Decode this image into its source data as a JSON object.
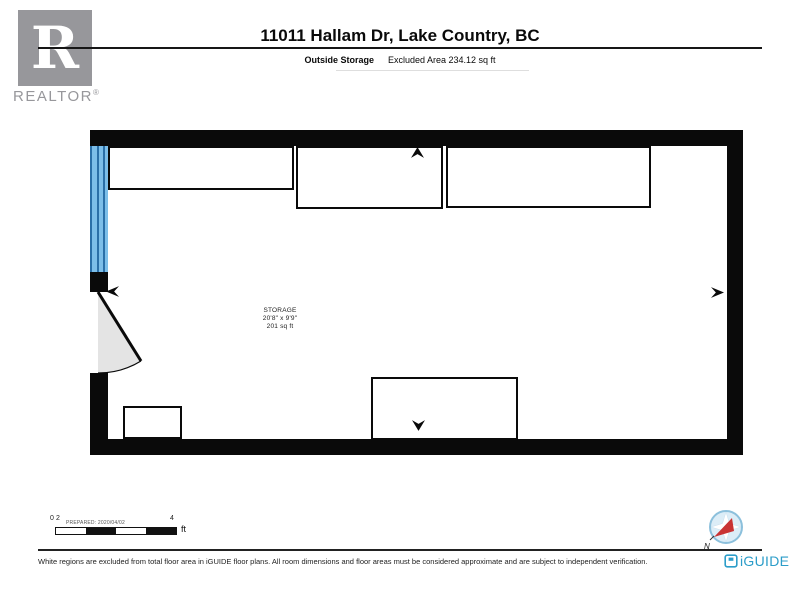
{
  "header": {
    "logo": {
      "letter": "R",
      "wordmark": "REALTOR",
      "registered": "®"
    },
    "title": "11011 Hallam Dr, Lake Country, BC",
    "section_label": "Outside Storage",
    "excluded_area": "Excluded Area 234.12 sq ft"
  },
  "floor_plan": {
    "room": {
      "name": "STORAGE",
      "dimensions": "20'8\" x 9'9\"",
      "area": "201 sq ft"
    }
  },
  "scale_bar": {
    "tick_labels": [
      "0",
      "2",
      "4"
    ],
    "unit": "ft",
    "prepared_label": "PREPARED: 2020/04/02"
  },
  "compass": {
    "north_label": "N"
  },
  "footer": {
    "disclaimer": "White regions are excluded from total floor area in iGUIDE floor plans. All room dimensions and floor areas must be considered approximate and are subject to independent verification.",
    "brand": "iGUIDE"
  },
  "colors": {
    "wall": "#0a0a0a",
    "window_blue": "#7cbee9",
    "window_frame_blue": "#2a6fa8",
    "door_swing_gray": "#e4e4e4",
    "realtor_gray": "#97979b",
    "iguide_blue": "#2c9dc9",
    "compass_ring": "#8cc0dc",
    "compass_fill": "#dcedf7",
    "compass_needle": "#c93434"
  }
}
